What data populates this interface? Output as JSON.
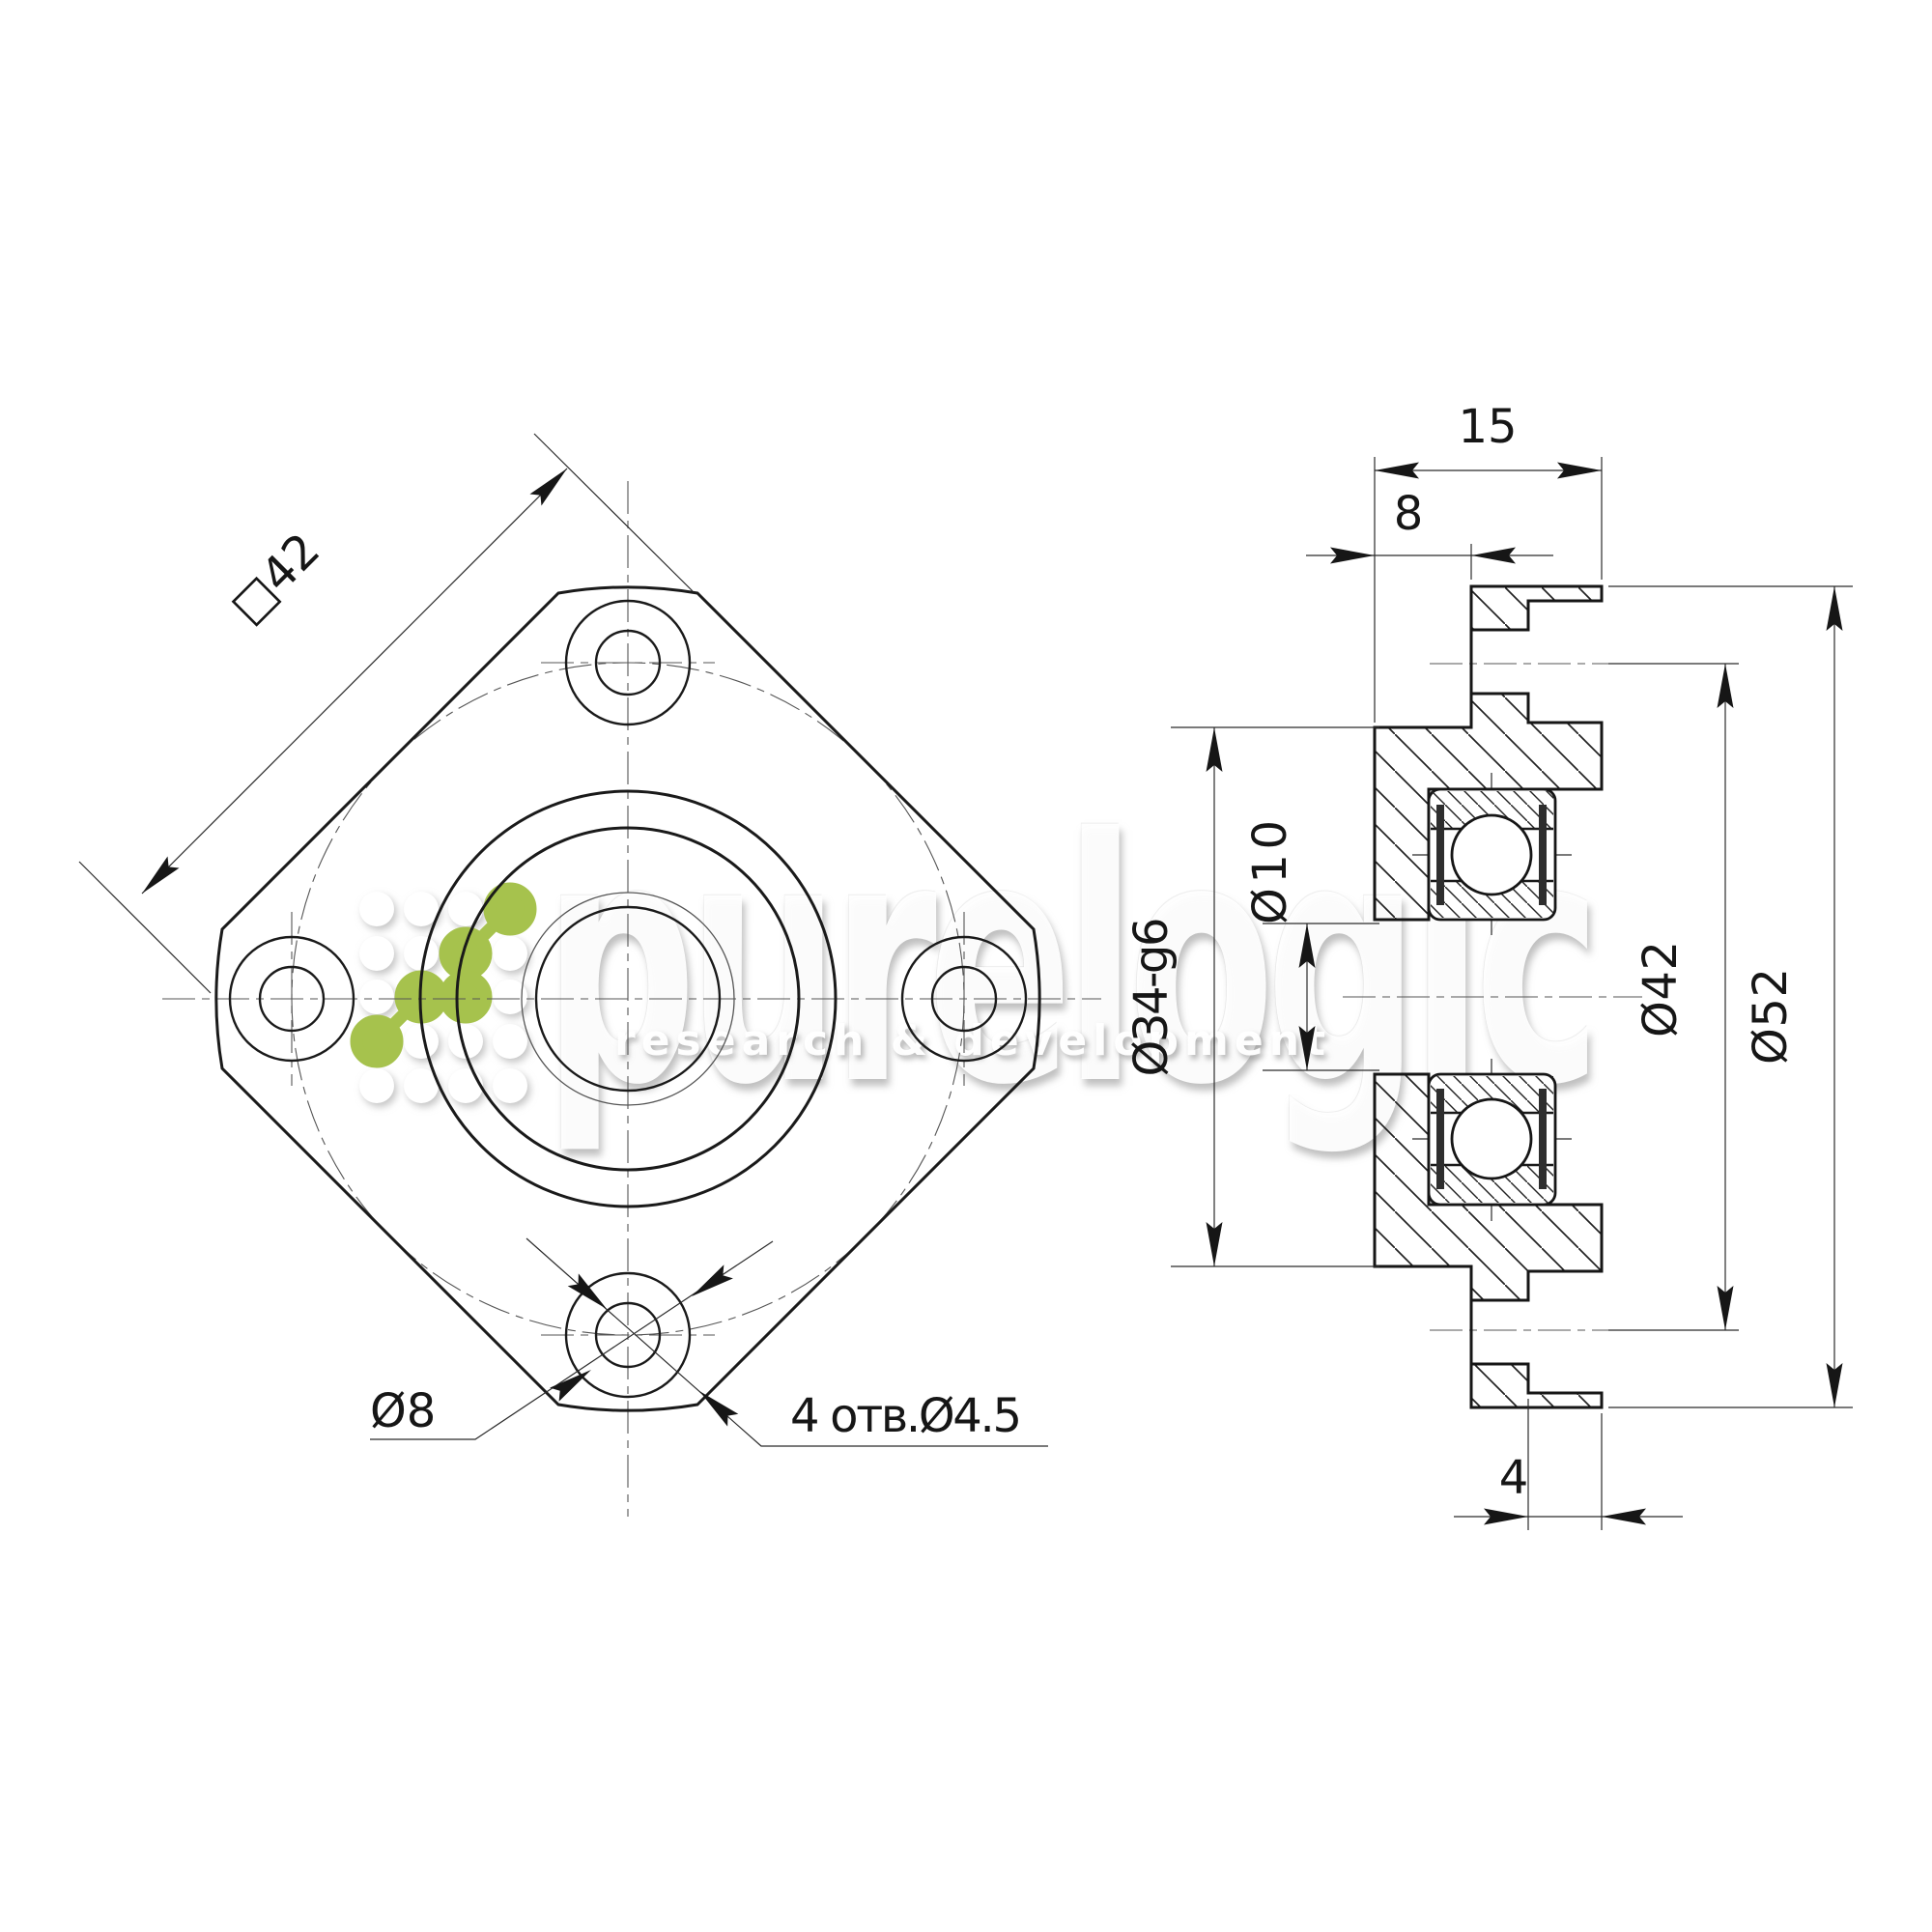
{
  "drawing": {
    "type": "engineering-drawing",
    "views": [
      "front view (square flange)",
      "side section view (bearing unit)"
    ]
  },
  "front_view": {
    "square_label": "□42",
    "counterbore_label": "Ø8",
    "holes_label": "4 отв.Ø4.5"
  },
  "side_view": {
    "width_total": "15",
    "width_body": "8",
    "flange_thickness": "4",
    "bore": "Ø10",
    "spigot": "Ø34-g6",
    "bolt_circle": "Ø42",
    "flange_od": "Ø52"
  },
  "watermark": {
    "brand": "purelogic",
    "tagline": "research & development"
  },
  "colors": {
    "line": "#1a1a1a",
    "green": "#a6c24d"
  }
}
